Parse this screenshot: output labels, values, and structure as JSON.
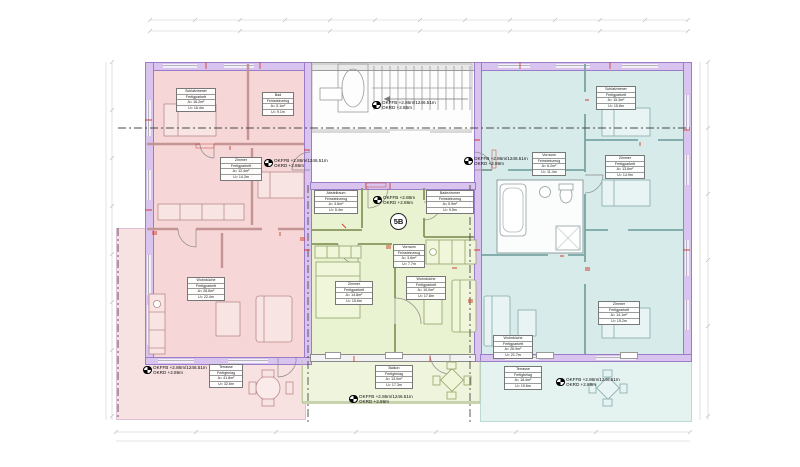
{
  "badge": {
    "unit": "5B"
  },
  "colors": {
    "pink_unit": "#f6d6d6",
    "green_unit": "#e9f2d1",
    "cyan_unit": "#d6ebea",
    "wall_insulation_purple": "#d9c4ef",
    "accent_red": "#d04133"
  },
  "elevations": {
    "stair": {
      "l1": "OKFFB +2.86m/1246.51m",
      "l2": "OKRD +2.86m"
    },
    "pink": {
      "l1": "OKFFB +2.86m/1246.51m",
      "l2": "OKRD +2.86m"
    },
    "pink_terrace": {
      "l1": "OKFFB +2.86m/1246.51m",
      "l2": "OKRD +2.86m"
    },
    "green": {
      "l1": "OKFFB +2.86m",
      "l2": "OKRD +2.86m"
    },
    "green_balcony": {
      "l1": "OKFFB +2.86m/1246.51m",
      "l2": "OKRD +2.86m"
    },
    "cyan": {
      "l1": "OKFFB +2.86m/1246.51m",
      "l2": "OKRD +2.86m"
    },
    "cyan_terrace": {
      "l1": "OKFFB +2.86m/1246.51m",
      "l2": "OKRD +2.86m"
    }
  },
  "rooms": {
    "pink_bed": {
      "name": "Schlafzimmer",
      "finish": "Fertigparkett",
      "area": "A= 16.2m²",
      "perim": "U= 16.4m"
    },
    "pink_bad": {
      "name": "Bad",
      "finish": "Feinsteinzeug",
      "area": "A= 5.1m²",
      "perim": "U= 9.1m"
    },
    "pink_room": {
      "name": "Zimmer",
      "finish": "Fertigparkett",
      "area": "A= 12.4m²",
      "perim": "U= 14.3m"
    },
    "pink_living": {
      "name": "Wohnküche",
      "finish": "Fertigparkett",
      "area": "A= 28.6m²",
      "perim": "U= 22.4m"
    },
    "pink_terrace": {
      "name": "Terrasse",
      "finish": "Fertigbelag",
      "area": "A= 41.8m²",
      "perim": "U= 32.6m"
    },
    "green_store": {
      "name": "Abstellraum",
      "finish": "Feinsteinzeug",
      "area": "A= 3.6m²",
      "perim": "U= 5.4m"
    },
    "green_bad": {
      "name": "Badezimmer",
      "finish": "Feinsteinzeug",
      "area": "A= 5.9m²",
      "perim": "U= 9.5m"
    },
    "green_hall": {
      "name": "Vorraum",
      "finish": "Feinsteinzeug",
      "area": "A= 3.6m²",
      "perim": "U= 7.7m"
    },
    "green_bed": {
      "name": "Zimmer",
      "finish": "Fertigparkett",
      "area": "A= 14.8m²",
      "perim": "U= 15.6m"
    },
    "green_living": {
      "name": "Wohnküche",
      "finish": "Fertigparkett",
      "area": "A= 19.0m²",
      "perim": "U= 17.8m"
    },
    "green_balcony": {
      "name": "Balkon",
      "finish": "Fertigbelag",
      "area": "A= 13.0m²",
      "perim": "U= 17.3m"
    },
    "cyan_bed1": {
      "name": "Schlafzimmer",
      "finish": "Fertigparkett",
      "area": "A= 15.3m²",
      "perim": "U= 15.8m"
    },
    "cyan_hall": {
      "name": "Vorraum",
      "finish": "Feinsteinzeug",
      "area": "A= 6.2m²",
      "perim": "U= 11.4m"
    },
    "cyan_bed2": {
      "name": "Zimmer",
      "finish": "Fertigparkett",
      "area": "A= 13.6m²",
      "perim": "U= 14.9m"
    },
    "cyan_bed3": {
      "name": "Zimmer",
      "finish": "Fertigparkett",
      "area": "A= 14.1m²",
      "perim": "U= 15.2m"
    },
    "cyan_living": {
      "name": "Wohnküche",
      "finish": "Fertigparkett",
      "area": "A= 26.9m²",
      "perim": "U= 21.7m"
    },
    "cyan_terrace": {
      "name": "Terrasse",
      "finish": "Fertigbelag",
      "area": "A= 18.4m²",
      "perim": "U= 19.6m"
    }
  }
}
